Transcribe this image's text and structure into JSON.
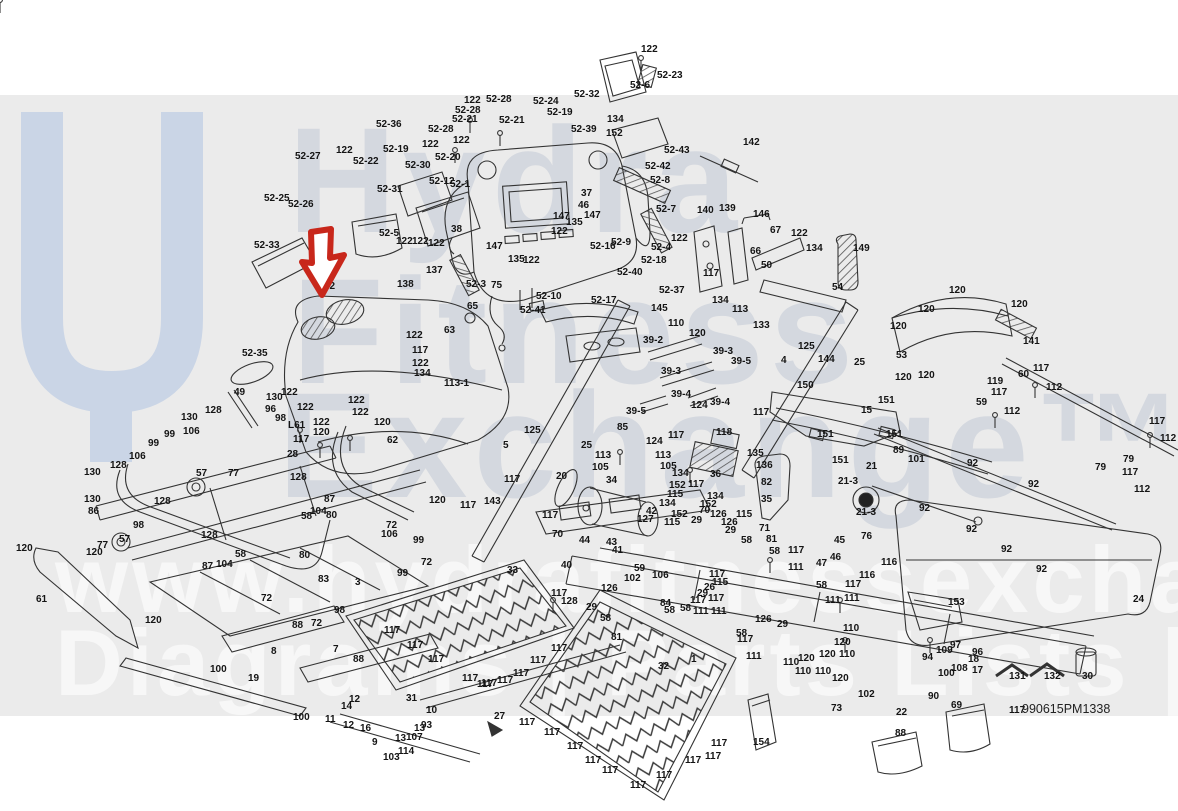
{
  "meta": {
    "sheet_number": "990615PM1338"
  },
  "colors": {
    "band_bg": "#ebebeb",
    "logo_blue": "#cad5e6",
    "arrow_red": "#c8271b",
    "line_ink": "#333333",
    "label_ink": "#141414"
  },
  "watermark": {
    "logo_icon": "hydra-u-logo",
    "line1": "Hydra",
    "line2": "Fitness",
    "line3": "Exchange™",
    "url_line": "www.hydrafitnessexchange.com",
    "tagline": "Diagrams | Parts Lists | And More"
  },
  "callout": {
    "target_label": "52-2",
    "shape": "down-arrow"
  },
  "labels": [
    [
      "122",
      641,
      52
    ],
    [
      "52-23",
      657,
      78
    ],
    [
      "52-6",
      630,
      88
    ],
    [
      "52-32",
      574,
      97
    ],
    [
      "52-39",
      571,
      132
    ],
    [
      "134",
      607,
      122
    ],
    [
      "152",
      606,
      136
    ],
    [
      "52-36",
      376,
      127
    ],
    [
      "52-27",
      295,
      159
    ],
    [
      "122",
      336,
      153
    ],
    [
      "52-22",
      353,
      164
    ],
    [
      "52-19",
      383,
      152
    ],
    [
      "122",
      422,
      147
    ],
    [
      "52-30",
      405,
      168
    ],
    [
      "52-31",
      377,
      192
    ],
    [
      "52-25",
      264,
      201
    ],
    [
      "52-26",
      288,
      207
    ],
    [
      "52-33",
      254,
      248
    ],
    [
      "52-35",
      242,
      356
    ],
    [
      "52-5",
      379,
      236
    ],
    [
      "122",
      396,
      244
    ],
    [
      "122",
      412,
      244
    ],
    [
      "122",
      428,
      246
    ],
    [
      "38",
      451,
      232
    ],
    [
      "147",
      486,
      249
    ],
    [
      "135",
      508,
      262
    ],
    [
      "122",
      523,
      263
    ],
    [
      "147",
      553,
      219
    ],
    [
      "147",
      584,
      218
    ],
    [
      "135",
      566,
      225
    ],
    [
      "122",
      551,
      234
    ],
    [
      "46",
      578,
      208
    ],
    [
      "37",
      581,
      196
    ],
    [
      "52-28",
      486,
      102
    ],
    [
      "122",
      464,
      103
    ],
    [
      "52-28",
      455,
      113
    ],
    [
      "52-21",
      452,
      122
    ],
    [
      "52-21",
      499,
      123
    ],
    [
      "52-24",
      533,
      104
    ],
    [
      "52-19",
      547,
      115
    ],
    [
      "52-28",
      428,
      132
    ],
    [
      "52-20",
      435,
      160
    ],
    [
      "122",
      453,
      143
    ],
    [
      "52-12",
      429,
      184
    ],
    [
      "52-1",
      450,
      187
    ],
    [
      "52-43",
      664,
      153
    ],
    [
      "142",
      743,
      145
    ],
    [
      "52-42",
      645,
      169
    ],
    [
      "52-8",
      650,
      183
    ],
    [
      "52-7",
      656,
      212
    ],
    [
      "52-4",
      651,
      250
    ],
    [
      "52-18",
      641,
      263
    ],
    [
      "52-40",
      617,
      275
    ],
    [
      "52-37",
      659,
      293
    ],
    [
      "52-16",
      590,
      249
    ],
    [
      "52-9",
      611,
      245
    ],
    [
      "52-3",
      466,
      287
    ],
    [
      "75",
      491,
      288
    ],
    [
      "65",
      467,
      309
    ],
    [
      "52-10",
      536,
      299
    ],
    [
      "52-41",
      520,
      313
    ],
    [
      "52-17",
      591,
      303
    ],
    [
      "117",
      703,
      276
    ],
    [
      "122",
      671,
      241
    ],
    [
      "140",
      697,
      213
    ],
    [
      "139",
      719,
      211
    ],
    [
      "146",
      753,
      217
    ],
    [
      "66",
      750,
      254
    ],
    [
      "67",
      770,
      233
    ],
    [
      "122",
      791,
      236
    ],
    [
      "134",
      806,
      251
    ],
    [
      "149",
      853,
      251
    ],
    [
      "50",
      761,
      268
    ],
    [
      "54",
      832,
      290
    ],
    [
      "134",
      712,
      303
    ],
    [
      "113",
      732,
      312
    ],
    [
      "133",
      753,
      328
    ],
    [
      "145",
      651,
      311
    ],
    [
      "110",
      668,
      326
    ],
    [
      "120",
      689,
      336
    ],
    [
      "39-2",
      643,
      343
    ],
    [
      "39-3",
      713,
      354
    ],
    [
      "39-3",
      661,
      374
    ],
    [
      "39-5",
      731,
      364
    ],
    [
      "39-5",
      626,
      414
    ],
    [
      "39-4",
      671,
      397
    ],
    [
      "39-4",
      710,
      405
    ],
    [
      "124",
      691,
      408
    ],
    [
      "125",
      798,
      349
    ],
    [
      "144",
      818,
      362
    ],
    [
      "4",
      781,
      363
    ],
    [
      "5",
      503,
      448
    ],
    [
      "25",
      854,
      365
    ],
    [
      "53",
      896,
      358
    ],
    [
      "120",
      895,
      380
    ],
    [
      "120",
      949,
      293
    ],
    [
      "120",
      918,
      312
    ],
    [
      "120",
      890,
      329
    ],
    [
      "120",
      1011,
      307
    ],
    [
      "120",
      918,
      378
    ],
    [
      "141",
      1023,
      344
    ],
    [
      "119",
      987,
      384
    ],
    [
      "60",
      1018,
      377
    ],
    [
      "117",
      1033,
      371
    ],
    [
      "112",
      1046,
      390
    ],
    [
      "59",
      976,
      405
    ],
    [
      "117",
      991,
      395
    ],
    [
      "112",
      1004,
      414
    ],
    [
      "117",
      1149,
      424
    ],
    [
      "112",
      1160,
      441
    ],
    [
      "79",
      1095,
      470
    ],
    [
      "79",
      1123,
      462
    ],
    [
      "117",
      1122,
      475
    ],
    [
      "112",
      1134,
      492
    ],
    [
      "52-2",
      315,
      289
    ],
    [
      "138",
      397,
      287
    ],
    [
      "137",
      426,
      273
    ],
    [
      "63",
      444,
      333
    ],
    [
      "122",
      406,
      338
    ],
    [
      "117",
      412,
      353
    ],
    [
      "122",
      412,
      366
    ],
    [
      "134",
      414,
      376
    ],
    [
      "113-1",
      444,
      386
    ],
    [
      "122",
      281,
      395
    ],
    [
      "122",
      297,
      410
    ],
    [
      "122",
      313,
      425
    ],
    [
      "122",
      348,
      403
    ],
    [
      "122",
      352,
      415
    ],
    [
      "120",
      374,
      425
    ],
    [
      "49",
      234,
      395
    ],
    [
      "130",
      266,
      400
    ],
    [
      "96",
      265,
      412
    ],
    [
      "98",
      275,
      421
    ],
    [
      "L61",
      288,
      428
    ],
    [
      "117",
      293,
      442
    ],
    [
      "28",
      287,
      457
    ],
    [
      "128",
      290,
      480
    ],
    [
      "130",
      181,
      420
    ],
    [
      "128",
      205,
      413
    ],
    [
      "106",
      183,
      434
    ],
    [
      "99",
      164,
      437
    ],
    [
      "99",
      148,
      446
    ],
    [
      "106",
      129,
      459
    ],
    [
      "128",
      110,
      468
    ],
    [
      "130",
      84,
      475
    ],
    [
      "130",
      84,
      502
    ],
    [
      "86",
      88,
      514
    ],
    [
      "128",
      154,
      504
    ],
    [
      "98",
      133,
      528
    ],
    [
      "57",
      196,
      476
    ],
    [
      "77",
      228,
      476
    ],
    [
      "57",
      119,
      542
    ],
    [
      "77",
      97,
      548
    ],
    [
      "128",
      201,
      538
    ],
    [
      "87",
      202,
      569
    ],
    [
      "104",
      216,
      567
    ],
    [
      "58",
      235,
      557
    ],
    [
      "120",
      16,
      551
    ],
    [
      "120",
      86,
      555
    ],
    [
      "61",
      36,
      602
    ],
    [
      "120",
      145,
      623
    ],
    [
      "87",
      324,
      502
    ],
    [
      "104",
      310,
      514
    ],
    [
      "58",
      301,
      519
    ],
    [
      "80",
      326,
      518
    ],
    [
      "72",
      386,
      528
    ],
    [
      "106",
      381,
      537
    ],
    [
      "99",
      413,
      543
    ],
    [
      "72",
      421,
      565
    ],
    [
      "99",
      397,
      576
    ],
    [
      "80",
      299,
      558
    ],
    [
      "83",
      318,
      582
    ],
    [
      "3",
      355,
      585
    ],
    [
      "33",
      507,
      573
    ],
    [
      "120",
      313,
      435
    ],
    [
      "62",
      387,
      443
    ],
    [
      "120",
      429,
      503
    ],
    [
      "117",
      504,
      482
    ],
    [
      "143",
      484,
      504
    ],
    [
      "117",
      460,
      508
    ],
    [
      "117",
      542,
      518
    ],
    [
      "70",
      552,
      537
    ],
    [
      "125",
      524,
      433
    ],
    [
      "85",
      617,
      430
    ],
    [
      "25",
      581,
      448
    ],
    [
      "113",
      595,
      458
    ],
    [
      "113",
      655,
      458
    ],
    [
      "105",
      592,
      470
    ],
    [
      "105",
      660,
      469
    ],
    [
      "117",
      668,
      438
    ],
    [
      "118",
      716,
      435
    ],
    [
      "36",
      710,
      477
    ],
    [
      "135",
      747,
      456
    ],
    [
      "136",
      756,
      468
    ],
    [
      "34",
      606,
      483
    ],
    [
      "124",
      646,
      444
    ],
    [
      "134",
      672,
      476
    ],
    [
      "152",
      669,
      488
    ],
    [
      "115",
      667,
      497
    ],
    [
      "117",
      688,
      487
    ],
    [
      "134",
      707,
      499
    ],
    [
      "152",
      700,
      507
    ],
    [
      "115",
      736,
      517
    ],
    [
      "134",
      659,
      506
    ],
    [
      "152",
      671,
      517
    ],
    [
      "115",
      664,
      525
    ],
    [
      "82",
      761,
      485
    ],
    [
      "35",
      761,
      502
    ],
    [
      "42",
      646,
      514
    ],
    [
      "127",
      637,
      522
    ],
    [
      "70",
      699,
      513
    ],
    [
      "126",
      710,
      517
    ],
    [
      "29",
      691,
      523
    ],
    [
      "126",
      721,
      525
    ],
    [
      "29",
      725,
      533
    ],
    [
      "71",
      759,
      531
    ],
    [
      "44",
      579,
      543
    ],
    [
      "43",
      606,
      545
    ],
    [
      "41",
      612,
      553
    ],
    [
      "40",
      561,
      568
    ],
    [
      "26",
      704,
      590
    ],
    [
      "20",
      556,
      479
    ],
    [
      "117",
      753,
      415
    ],
    [
      "58",
      741,
      543
    ],
    [
      "81",
      766,
      542
    ],
    [
      "58",
      769,
      554
    ],
    [
      "117",
      788,
      553
    ],
    [
      "111",
      788,
      570
    ],
    [
      "59",
      634,
      571
    ],
    [
      "102",
      624,
      581
    ],
    [
      "106",
      652,
      578
    ],
    [
      "84",
      660,
      606
    ],
    [
      "29",
      697,
      596
    ],
    [
      "117",
      709,
      577
    ],
    [
      "115",
      712,
      585
    ],
    [
      "117",
      708,
      601
    ],
    [
      "111",
      711,
      614
    ],
    [
      "58",
      680,
      611
    ],
    [
      "58",
      664,
      613
    ],
    [
      "58",
      600,
      621
    ],
    [
      "81",
      611,
      640
    ],
    [
      "126",
      755,
      622
    ],
    [
      "29",
      777,
      627
    ],
    [
      "117",
      845,
      587
    ],
    [
      "111",
      844,
      601
    ],
    [
      "58",
      816,
      588
    ],
    [
      "45",
      834,
      543
    ],
    [
      "47",
      816,
      566
    ],
    [
      "46",
      830,
      560
    ],
    [
      "76",
      861,
      539
    ],
    [
      "116",
      881,
      565
    ],
    [
      "116",
      859,
      578
    ],
    [
      "126",
      601,
      591
    ],
    [
      "128",
      561,
      604
    ],
    [
      "117",
      551,
      596
    ],
    [
      "29",
      586,
      610
    ],
    [
      "117",
      690,
      603
    ],
    [
      "111",
      693,
      614
    ],
    [
      "111",
      825,
      603
    ],
    [
      "117",
      737,
      642
    ],
    [
      "111",
      746,
      659
    ],
    [
      "58",
      736,
      636
    ],
    [
      "110",
      843,
      631
    ],
    [
      "120",
      834,
      645
    ],
    [
      "120",
      819,
      657
    ],
    [
      "110",
      839,
      657
    ],
    [
      "120",
      832,
      681
    ],
    [
      "110",
      783,
      665
    ],
    [
      "120",
      798,
      661
    ],
    [
      "110",
      795,
      674
    ],
    [
      "110",
      815,
      674
    ],
    [
      "102",
      858,
      697
    ],
    [
      "73",
      831,
      711
    ],
    [
      "22",
      896,
      715
    ],
    [
      "90",
      928,
      699
    ],
    [
      "100",
      938,
      676
    ],
    [
      "94",
      922,
      660
    ],
    [
      "97",
      950,
      648
    ],
    [
      "109",
      936,
      653
    ],
    [
      "96",
      972,
      655
    ],
    [
      "18",
      968,
      662
    ],
    [
      "108",
      951,
      671
    ],
    [
      "17",
      972,
      673
    ],
    [
      "69",
      951,
      708
    ],
    [
      "131",
      1009,
      679
    ],
    [
      "132",
      1044,
      679
    ],
    [
      "30",
      1082,
      679
    ],
    [
      "117",
      1009,
      713
    ],
    [
      "88",
      895,
      736
    ],
    [
      "92",
      967,
      466
    ],
    [
      "92",
      1028,
      487
    ],
    [
      "92",
      919,
      511
    ],
    [
      "92",
      966,
      532
    ],
    [
      "92",
      1001,
      552
    ],
    [
      "92",
      1036,
      572
    ],
    [
      "24",
      1133,
      602
    ],
    [
      "153",
      948,
      605
    ],
    [
      "150",
      797,
      388
    ],
    [
      "15",
      861,
      413
    ],
    [
      "151",
      878,
      403
    ],
    [
      "151",
      817,
      437
    ],
    [
      "151",
      886,
      437
    ],
    [
      "151",
      832,
      463
    ],
    [
      "21",
      866,
      469
    ],
    [
      "21-3",
      838,
      484
    ],
    [
      "21-3",
      856,
      515
    ],
    [
      "89",
      893,
      453
    ],
    [
      "101",
      908,
      462
    ],
    [
      "1",
      691,
      662
    ],
    [
      "32",
      658,
      669
    ],
    [
      "27",
      494,
      719
    ],
    [
      "31",
      406,
      701
    ],
    [
      "10",
      426,
      713
    ],
    [
      "93",
      421,
      728
    ],
    [
      "13",
      414,
      731
    ],
    [
      "13",
      395,
      741
    ],
    [
      "107",
      406,
      740
    ],
    [
      "9",
      372,
      745
    ],
    [
      "114",
      398,
      754
    ],
    [
      "103",
      383,
      760
    ],
    [
      "11",
      325,
      722
    ],
    [
      "12",
      349,
      702
    ],
    [
      "12",
      343,
      728
    ],
    [
      "14",
      341,
      709
    ],
    [
      "16",
      360,
      731
    ],
    [
      "7",
      333,
      652
    ],
    [
      "8",
      271,
      654
    ],
    [
      "88",
      292,
      628
    ],
    [
      "88",
      353,
      662
    ],
    [
      "72",
      261,
      601
    ],
    [
      "72",
      311,
      626
    ],
    [
      "19",
      248,
      681
    ],
    [
      "100",
      210,
      672
    ],
    [
      "100",
      293,
      720
    ],
    [
      "98",
      334,
      613
    ],
    [
      "154",
      753,
      745
    ],
    [
      "117",
      519,
      725
    ],
    [
      "117",
      544,
      735
    ],
    [
      "117",
      567,
      749
    ],
    [
      "117",
      585,
      763
    ],
    [
      "117",
      602,
      773
    ],
    [
      "117",
      630,
      788
    ],
    [
      "117",
      656,
      778
    ],
    [
      "117",
      685,
      763
    ],
    [
      "117",
      705,
      759
    ],
    [
      "117",
      711,
      746
    ],
    [
      "117",
      481,
      686
    ],
    [
      "117",
      497,
      683
    ],
    [
      "117",
      513,
      676
    ],
    [
      "117",
      530,
      663
    ],
    [
      "117",
      551,
      651
    ],
    [
      "117",
      384,
      633
    ],
    [
      "117",
      407,
      648
    ],
    [
      "117",
      428,
      662
    ],
    [
      "117",
      462,
      681
    ],
    [
      "117",
      477,
      687
    ]
  ]
}
